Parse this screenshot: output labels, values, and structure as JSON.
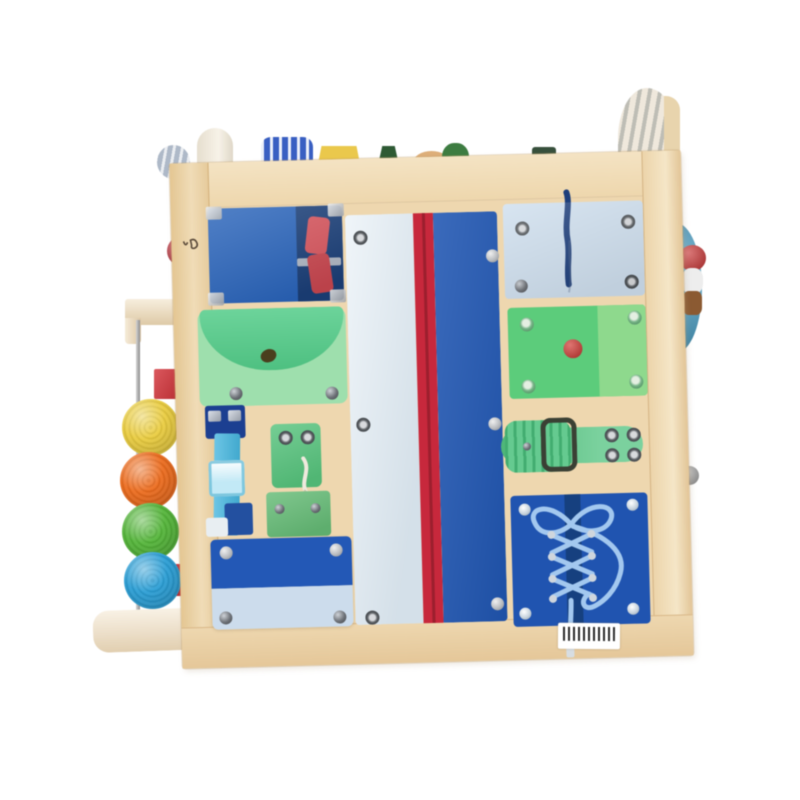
{
  "scene": {
    "type": "product-photo",
    "description": "Front face of a wooden toddler busy-board activity cube on a plain white background. The face holds fabric dressing-skill panels (clips, button pouch, buckle, snaps, pockets, zipper, cord, watch strap, shoe lacing). A vertical abacus rod with four crocheted balls is mounted on the left edge; small toys peek over the top edge; a blue disc with a small figure protrudes on the right edge.",
    "background_color": "#ffffff"
  },
  "board": {
    "face_color": "#eed7b0",
    "frame_light": "#f4e4c6",
    "frame_dark": "#e0c294",
    "logo_mark_color": "#5a4a3a"
  },
  "panels": {
    "clip_panel": {
      "name": "blue panel with red squeeze clips",
      "base": "#2b64b8",
      "underlay": "#1c3f77",
      "clip1": "#d5565e",
      "clip2": "#c74850",
      "bar": "#c9ccd1"
    },
    "button_pouch": {
      "name": "green button pouch",
      "base": "#9fdfae",
      "flap": "#55cb8a",
      "buttonhole": "#4a3f1f"
    },
    "buckle_strap": {
      "name": "blue buckle strap",
      "anchor": "#1d3f8f",
      "strap": "#49b7de",
      "buckle": "#c3e9f6",
      "bottom": "#24509e",
      "tab": "#e8eef2"
    },
    "snap_hook": {
      "name": "green snap and hook tabs",
      "top": "#58c37e",
      "bottom": "#66bb77",
      "cord": "#efe9dd"
    },
    "pocket": {
      "name": "two-tone flap pocket",
      "top": "#2458b4",
      "bottom": "#ccdcec"
    },
    "zipper_panel": {
      "name": "tall zipper panel",
      "left": "#dde9f2",
      "zipper": "#c5293c",
      "zipper_teeth": "#8e1e2b",
      "right": "#2156b0"
    },
    "cord_panel": {
      "name": "light blue panel with pull cord",
      "base": "#cfdfee",
      "cord": "#1f3f7a"
    },
    "button_panel": {
      "name": "green panel with red button",
      "base": "#5ecb7c",
      "base_light": "#8fd98e",
      "button": "#cf3a36"
    },
    "watch_strap": {
      "name": "green watch buckle strap",
      "strap": "#57c584",
      "wrap": "#4cc07e",
      "buckle": "#3a4034"
    },
    "lacing_panel": {
      "name": "blue shoe-lacing panel",
      "base": "#2154ae",
      "gap": "#17407e",
      "lace": "#a4c8ee",
      "aglet": "#d7dde2"
    }
  },
  "abacus": {
    "bracket_color": "#f0e0c2",
    "rod_color": "#9f9f9f",
    "foot_color": "#f2e4cb",
    "stop_color": "#cc2127",
    "balls": [
      {
        "name": "yellow-ball",
        "color": "#e9cd44"
      },
      {
        "name": "orange-ball",
        "color": "#ea6d22"
      },
      {
        "name": "green-ball",
        "color": "#57b53e"
      },
      {
        "name": "blue-ball",
        "color": "#2f9fd4"
      }
    ]
  },
  "side_right": {
    "disc_color": "#4aa0c6",
    "figure_cap": "#c53232",
    "figure_body": "#ededed",
    "figure_base": "#8a5a33",
    "knob_color": "#a8a8a8"
  },
  "side_left": {
    "knob_color": "#c23540"
  },
  "top_toys": [
    {
      "name": "grey-striped-ball",
      "color": "#aeb9c8"
    },
    {
      "name": "wooden-arch",
      "color": "#f2ead9"
    },
    {
      "name": "blue-white-caterpillar",
      "color": "#3a5fc0"
    },
    {
      "name": "yellow-house",
      "color": "#e9c84e"
    },
    {
      "name": "dark-green-cone",
      "color": "#2f5a35"
    },
    {
      "name": "tan-mound",
      "color": "#dcae7a"
    },
    {
      "name": "green-tree",
      "color": "#3e7c42"
    },
    {
      "name": "dark-green-block",
      "color": "#37503c"
    },
    {
      "name": "striped-arch-wheel",
      "color": "#efe8dc",
      "stripe": "#b9bdb9"
    }
  ],
  "barcode_label": {
    "background": "#ffffff",
    "bars": "#2a2a2a"
  }
}
